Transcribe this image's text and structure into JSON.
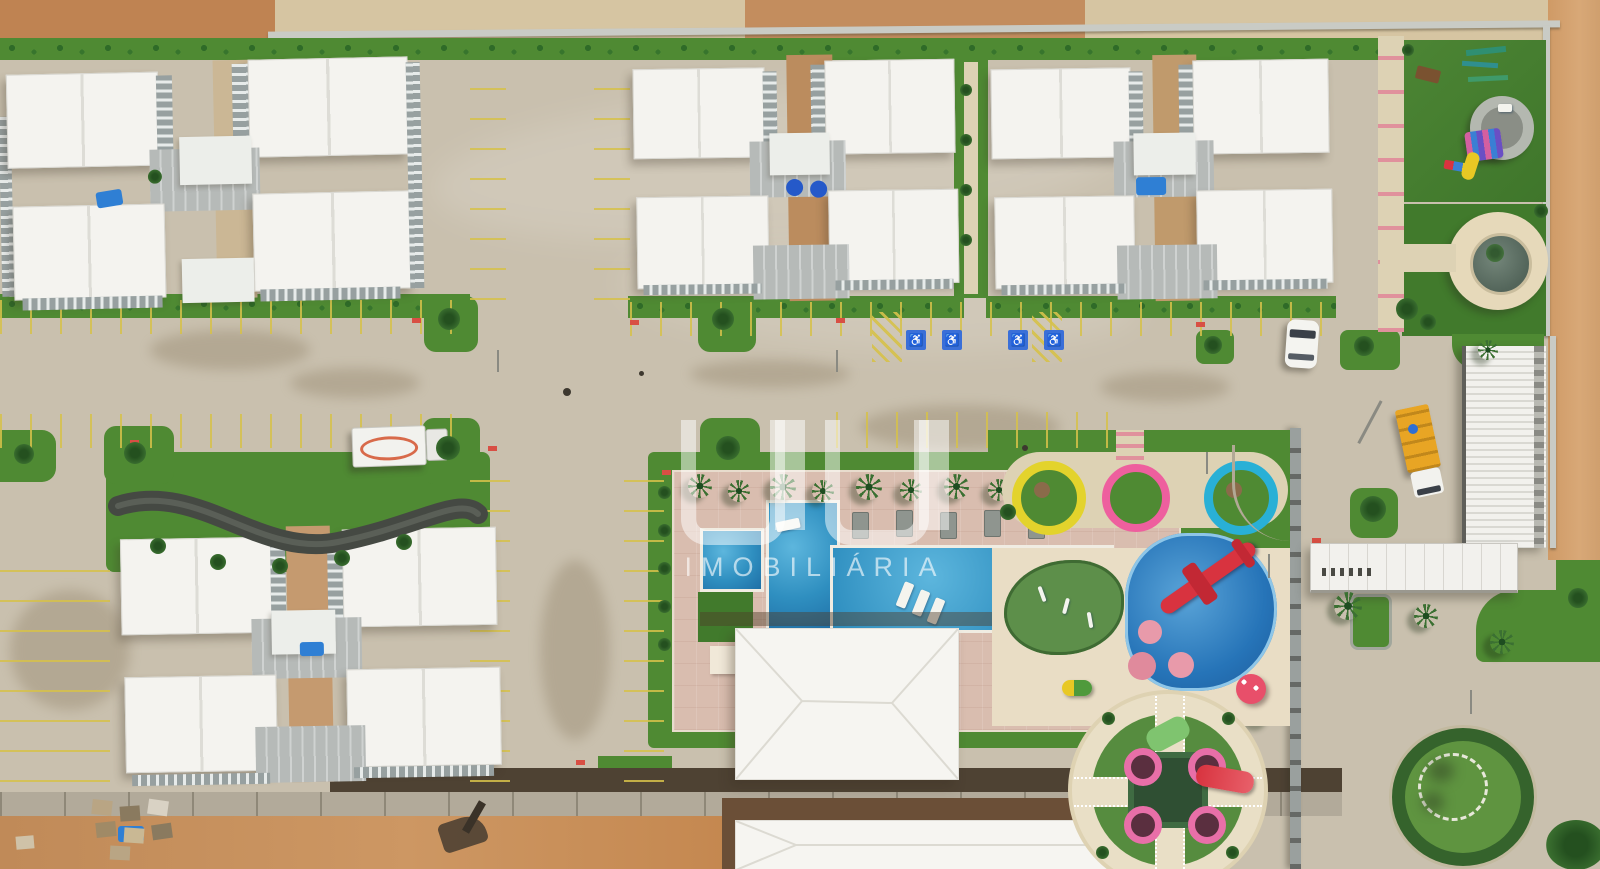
{
  "meta": {
    "scene": "aerial top-down drone photo of a residential condominium complex with white apartment blocks, swimming pool, playgrounds and internal roads",
    "view": "top-down"
  },
  "watermark": {
    "brand_text": "IMOBILIÁRIA"
  },
  "icons": {
    "accessible_parking": "♿"
  },
  "palette": {
    "pavement": "#cdc5b3",
    "road": "#c9c0ae",
    "sand": "#d8a877",
    "dirt": "#bf8352",
    "tan": "#d6c5a2",
    "grass": "#4f8a33",
    "grass_dark": "#2f5c28",
    "pool_water": "#2f8fc0",
    "kids_splash": "#2674b8",
    "pool_deck": "#d9bdaf",
    "roof_white": "#f4f3ef",
    "roof_gray": "#b6bab8",
    "facade_gray": "#97a0a0",
    "ring_yellow": "#e3d32c",
    "ring_pink": "#ee5f9e",
    "ring_blue": "#29b0d6",
    "accent_red": "#d84f44",
    "parking_yellow": "#d6c14a",
    "water_tank_blue": "#2f7fd4",
    "slide_red": "#d8333f",
    "canopy_white": "#f2f1ed"
  }
}
